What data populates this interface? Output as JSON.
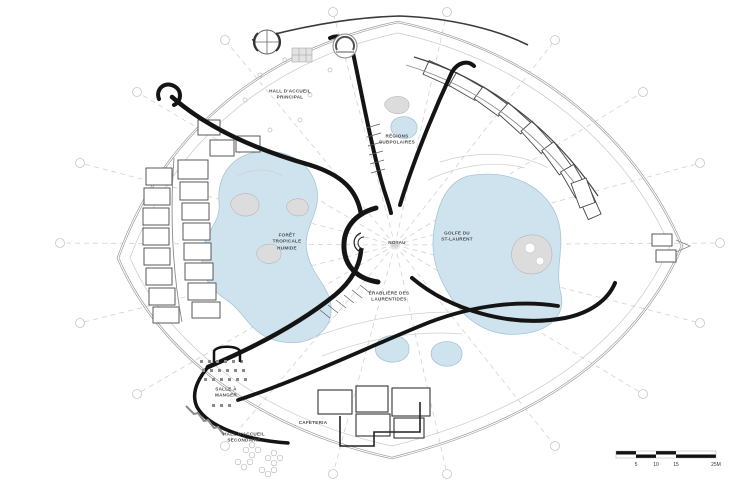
{
  "colors": {
    "background": "#ffffff",
    "water": "#cfe3ee",
    "waterline": "#a5c6d8",
    "wall": "#141414",
    "line": "#555555",
    "lightline": "#b5b5b5",
    "gridline": "#d2d2d2",
    "grayfill": "#dcdcdc",
    "label": "#4a4a4a"
  },
  "zones": {
    "hall_principal": "HALL D'ACCUEIL\nPRINCIPAL",
    "regions_subpolaires": "RÉGIONS\nSUBPOLAIRES",
    "foret_tropicale": "FORÊT\nTROPICALE\nHUMIDE",
    "noyau": "NOYAU",
    "golfe_st_laurent": "GOLFE DU\nST-LAURENT",
    "erabliere_laurentides": "ÉRABLIÈRE DES\nLAURENTIDES",
    "salle_a_manger": "SALLE À\nMANGER",
    "cafeteria": "CAFETERIA",
    "hall_secondaire": "HALL D'ACCUEIL\nSECONDAIRE"
  },
  "scalebar": {
    "tick_5": "5",
    "tick_10": "10",
    "tick_15": "15",
    "tick_25": "25M"
  }
}
